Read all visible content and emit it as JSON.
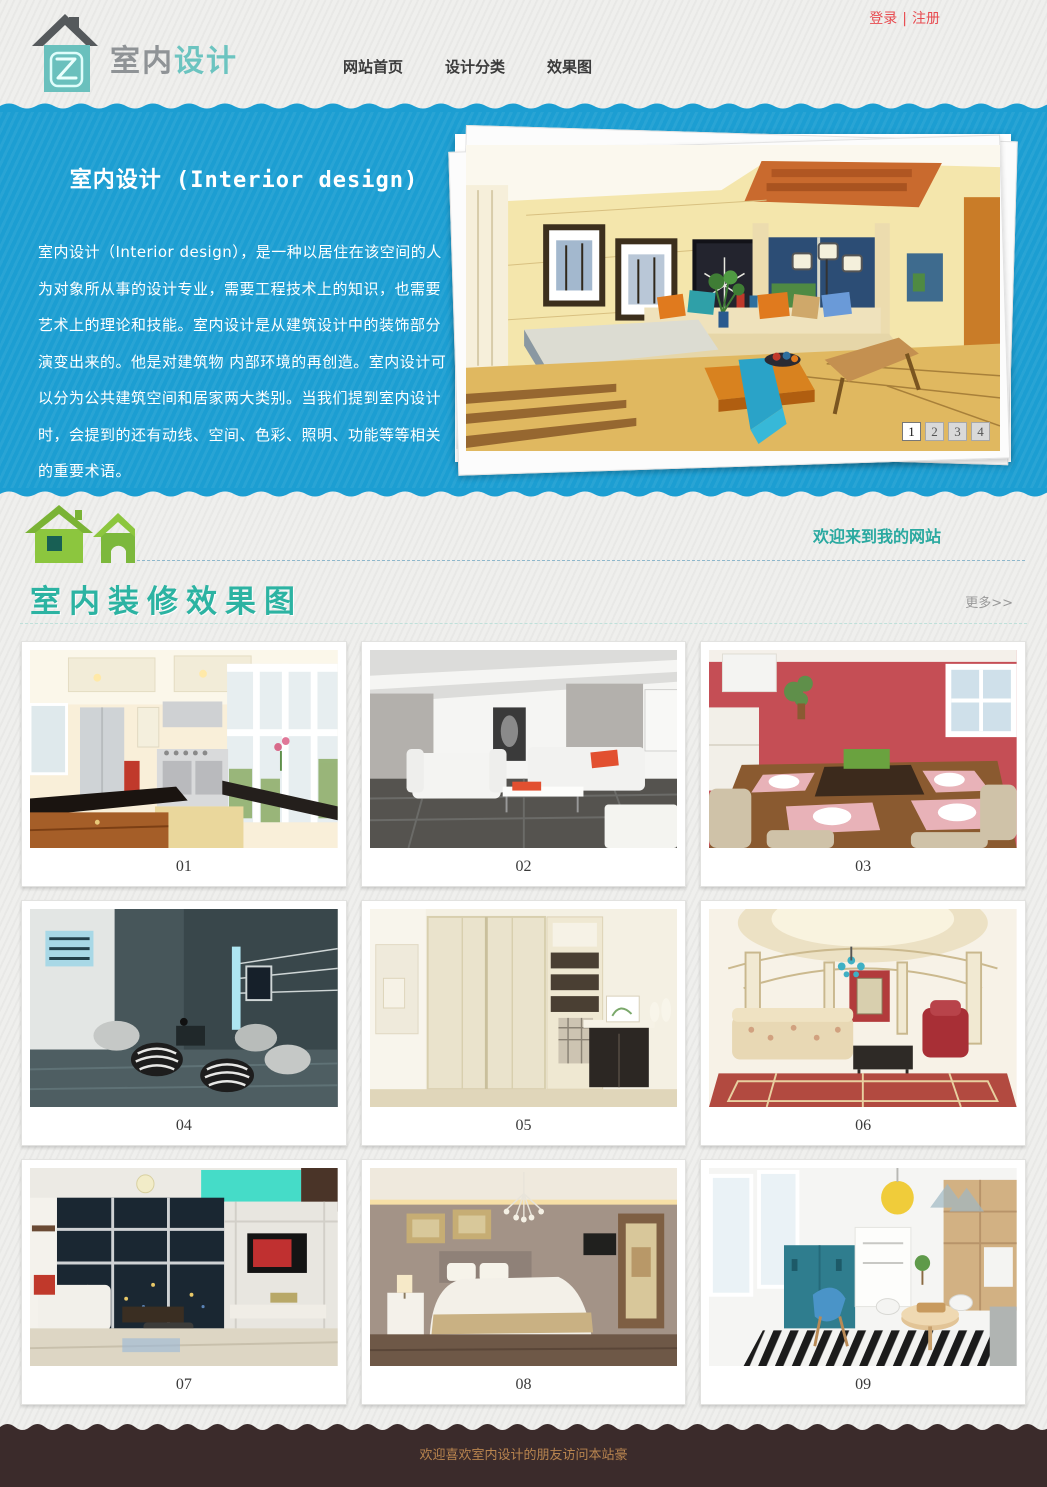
{
  "topbar": {
    "login_label": "登录",
    "separator": "|",
    "register_label": "注册"
  },
  "header": {
    "logo_text_gray": "室内",
    "logo_text_teal": "设计",
    "nav": [
      {
        "label": "网站首页"
      },
      {
        "label": "设计分类"
      },
      {
        "label": "效果图"
      }
    ]
  },
  "hero": {
    "title": "室内设计 (Interior design)",
    "paragraph": "室内设计（Interior design），是一种以居住在该空间的人为对象所从事的设计专业，需要工程技术上的知识，也需要艺术上的理论和技能。室内设计是从建筑设计中的装饰部分演变出来的。他是对建筑物 内部环境的再创造。室内设计可以分为公共建筑空间和居家两大类别。当我们提到室内设计时，会提到的还有动线、空间、色彩、照明、功能等等相关的重要术语。",
    "pagination": [
      {
        "label": "1",
        "active": true
      },
      {
        "label": "2",
        "active": false
      },
      {
        "label": "3",
        "active": false
      },
      {
        "label": "4",
        "active": false
      }
    ]
  },
  "welcome": {
    "message": "欢迎来到我的网站"
  },
  "gallery": {
    "title": "室内装修效果图",
    "more_label": "更多>>",
    "items": [
      {
        "caption": "01"
      },
      {
        "caption": "02"
      },
      {
        "caption": "03"
      },
      {
        "caption": "04"
      },
      {
        "caption": "05"
      },
      {
        "caption": "06"
      },
      {
        "caption": "07"
      },
      {
        "caption": "08"
      },
      {
        "caption": "09"
      }
    ]
  },
  "footer": {
    "text": "欢迎喜欢室内设计的朋友访问本站豪"
  },
  "icons": {
    "logo": "house-logo-icon",
    "welcome": "double-green-house-icon"
  },
  "colors": {
    "hero_blue": "#1c9ed2",
    "accent_teal": "#2cb3a2",
    "logo_teal": "#6ac0bd",
    "link_red": "#e84b50",
    "house_green": "#8cc63e",
    "footer_brown": "#3b2b2b",
    "footer_text": "#b9854f"
  }
}
